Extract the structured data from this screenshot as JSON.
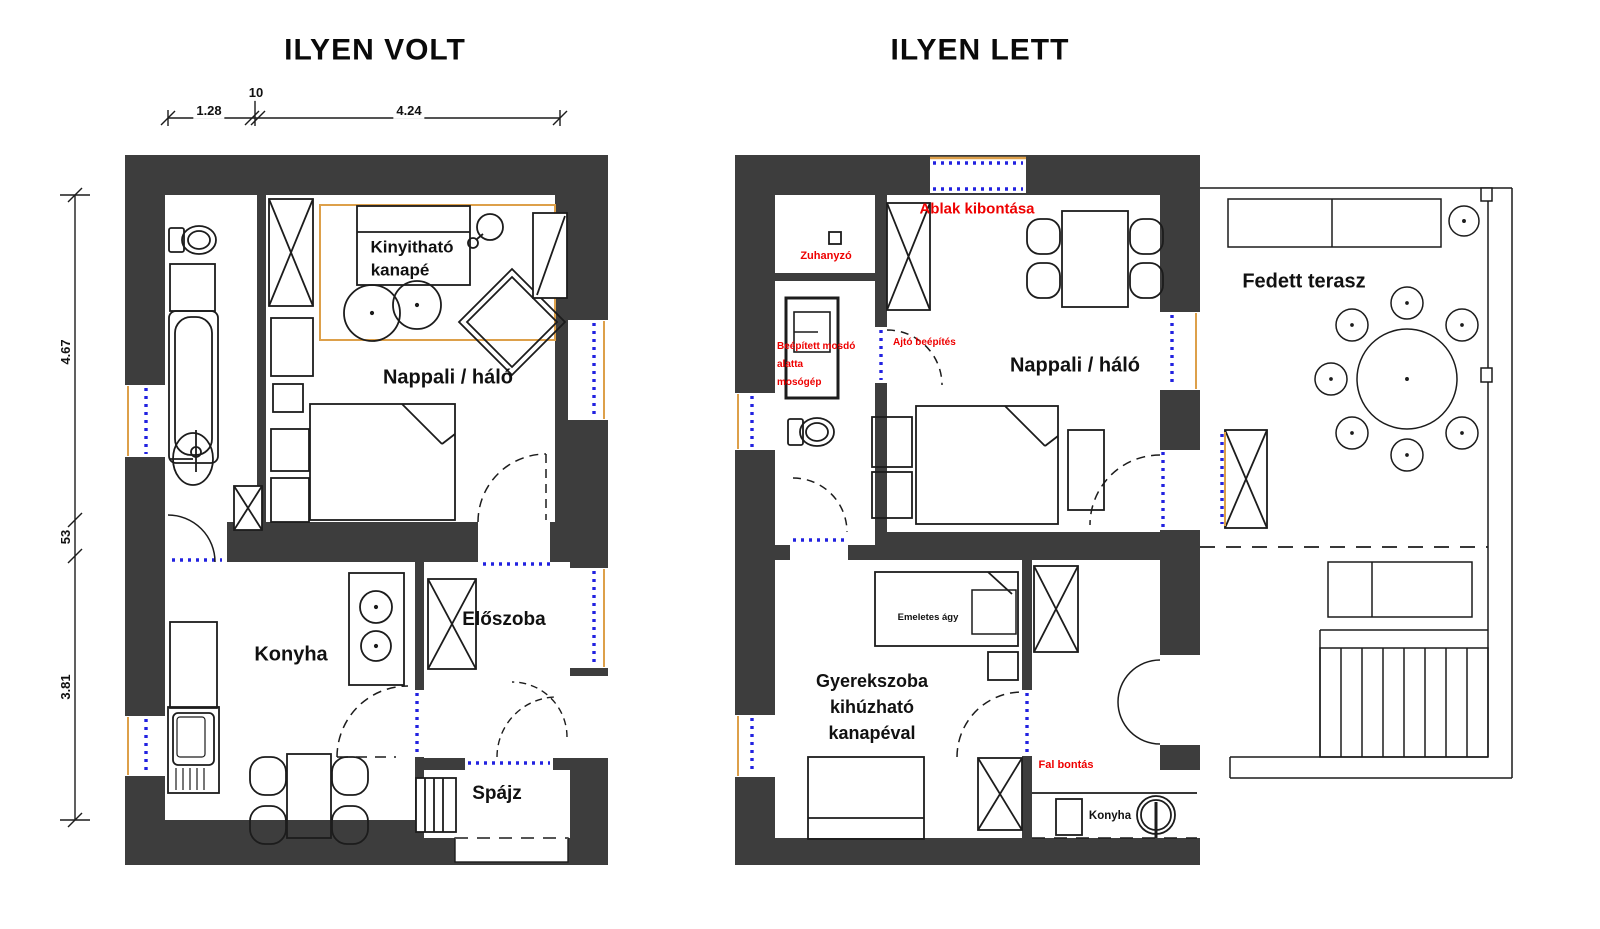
{
  "colors": {
    "wall": "#3d3d3d",
    "line": "#1c1c1c",
    "annotation_red": "#ee0000",
    "window_blue": "#2222e0",
    "accent_orange": "#dda04a",
    "background": "#ffffff"
  },
  "left_plan": {
    "title": "ILYEN VOLT",
    "dimensions": {
      "top": [
        "1.28",
        "10",
        "4.24"
      ],
      "left": [
        "4.67",
        "53",
        "3.81"
      ]
    },
    "labels": {
      "sofa_line1": "Kinyitható",
      "sofa_line2": "kanapé",
      "living": "Nappali / háló",
      "kitchen": "Konyha",
      "hall": "Előszoba",
      "pantry": "Spájz"
    }
  },
  "right_plan": {
    "title": "ILYEN LETT",
    "labels": {
      "living": "Nappali / háló",
      "terrace": "Fedett terasz",
      "kids_room": [
        "Gyerekszoba",
        "kihúzható",
        "kanapéval"
      ],
      "bunk_bed": "Emeletes ágy",
      "kitchen": "Konyha"
    },
    "annotations": {
      "window_removal": "Ablak kibontása",
      "shower": "Zuhanyzó",
      "built_in_sink": [
        "Beépített mosdó",
        "alatta",
        "mosógép"
      ],
      "door_install": "Ajtó beépítés",
      "wall_demolition": "Fal bontás"
    }
  }
}
